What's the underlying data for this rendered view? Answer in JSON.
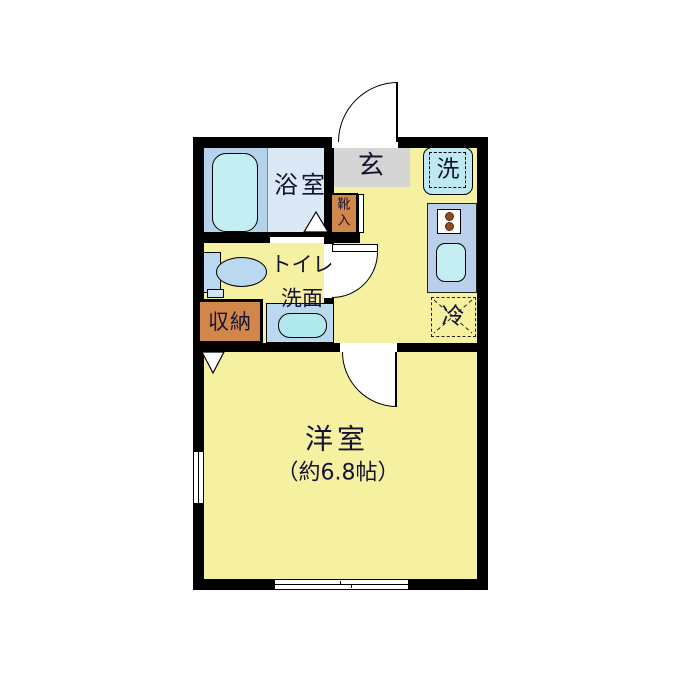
{
  "floorplan": {
    "type": "japanese-apartment-floorplan",
    "labels": {
      "bathroom": "浴室",
      "entrance": "玄",
      "washer": "洗",
      "shoe_chars": [
        "靴",
        "入"
      ],
      "toilet_line1": "トイレ",
      "toilet_line2": "洗面",
      "storage": "収納",
      "fridge": "冷",
      "main_room": "洋室",
      "main_room_size": "（約6.8帖）"
    },
    "main_room_size_jo": 6.8,
    "colors": {
      "wall": "#000000",
      "floor_yellow": "#f6f1a1",
      "entrance_gray": "#d5d5d5",
      "fixture_orange": "#d2874a",
      "bath_left_blue": "#b5d3ea",
      "bath_right_blue": "#dbe9f7",
      "tub_cyan": "#c3eef3",
      "washer_cyan": "#bfe9f2",
      "kitchen_counter_blue": "#b9cfea",
      "sink_cyan": "#c5eef2",
      "toilet_blue": "#bad8f0",
      "basin_cyan": "#b0eaee",
      "burner_brown": "#8c4a1e"
    }
  }
}
